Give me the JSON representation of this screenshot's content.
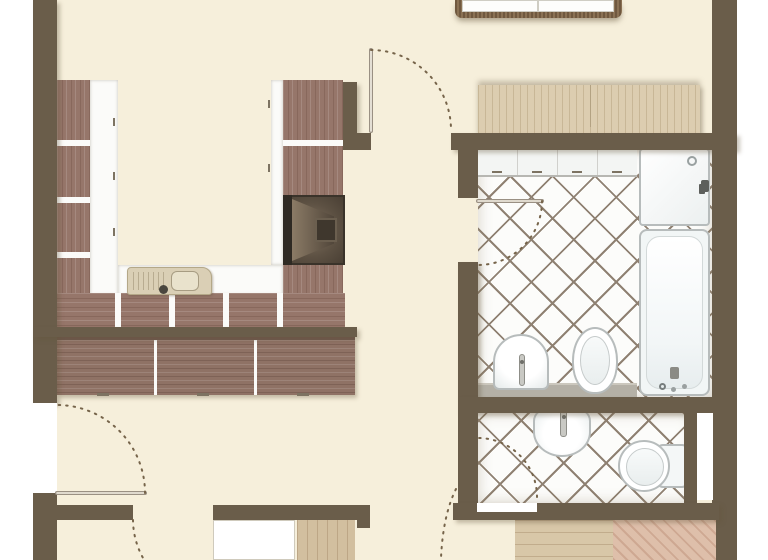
{
  "floorplan": {
    "type": "apartment-floor-plan-top-view",
    "no_visible_text": true,
    "colors": {
      "page_background": "#ffffff",
      "floor": "#f6efdb",
      "wall": "#6a5d4a",
      "kitchen_wood": "#96766a",
      "sideboard_wood": "#8f7265",
      "countertop": "#fbfbf9",
      "wardrobe_wood": "#dccdb0",
      "bench_rattan": "#8a7154",
      "tile_grout_line": "#8f8172",
      "tile_fill": "#fcfcfa",
      "fixture_outline": "#b7bcbc",
      "ledge_gray": "#b4b0a6",
      "stove_dark": "#473d32",
      "sink_unit_beige": "#dacfb5",
      "wood_floor_light": "#d8c7a8",
      "wood_floor_pink": "#debfaa",
      "door_swing_dash": "#76644a"
    },
    "rooms": [
      {
        "id": "living-area",
        "floor": "cream"
      },
      {
        "id": "kitchen",
        "floor": "cream",
        "layout": "u-shaped-counter"
      },
      {
        "id": "bathroom-main",
        "floor": "diagonal-tiles"
      },
      {
        "id": "wc",
        "floor": "diagonal-tiles"
      },
      {
        "id": "hallway-south",
        "floor": "cream-and-wood"
      }
    ],
    "kitchen": {
      "fixtures": [
        "cabinet-run-left",
        "cabinet-run-right",
        "cabinet-run-bottom",
        "white-countertop",
        "kitchen-sink-unit",
        "stove",
        "sideboard-3-sections"
      ]
    },
    "bathroom_main": {
      "fixtures": [
        "wall-cabinet-row",
        "shower-tray-with-drain",
        "bathtub-with-faucet",
        "washbasin",
        "toilet",
        "gray-ledge"
      ]
    },
    "wc": {
      "fixtures": [
        "round-washbasin-with-faucet",
        "toilet-with-cistern",
        "wall-niche"
      ]
    },
    "furniture": [
      "rattan-bench-top-edge",
      "wardrobe-light-wood"
    ],
    "doors": [
      {
        "id": "door-top-center",
        "style": "leaf-with-quarter-arc-swing"
      },
      {
        "id": "door-bathroom-left",
        "style": "leaf-with-quarter-arc-swing"
      },
      {
        "id": "door-exterior-left",
        "style": "leaf-with-quarter-arc-swing"
      },
      {
        "id": "door-wc-bottom",
        "style": "quarter-arc-swing"
      },
      {
        "id": "door-bottom-left-partial",
        "style": "arc-cut-by-image-edge"
      },
      {
        "id": "door-bottom-right-partial",
        "style": "arc-cut-by-image-edge"
      }
    ]
  }
}
